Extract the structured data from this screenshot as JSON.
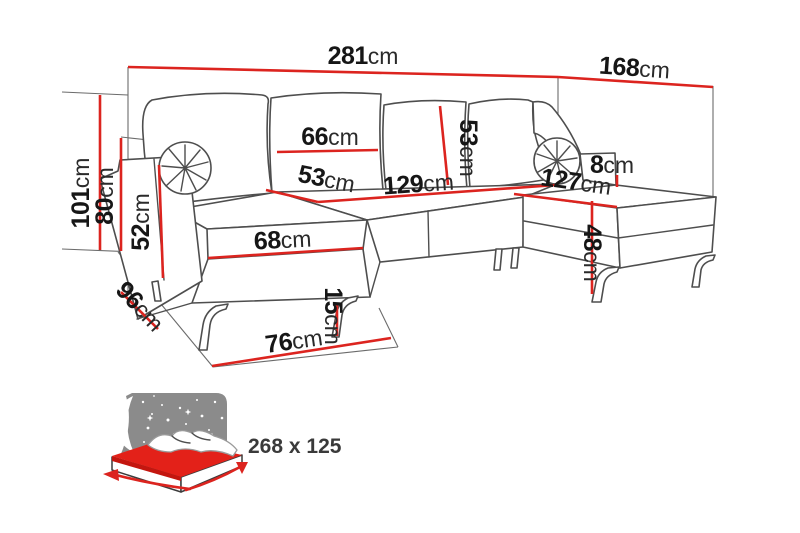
{
  "diagram_type": "sofa-dimension-diagram",
  "labels": {
    "total_width": {
      "num": "281",
      "unit": "cm"
    },
    "total_depth": {
      "num": "168",
      "unit": "cm"
    },
    "total_height": {
      "num": "101",
      "unit": "cm"
    },
    "backrest_height": {
      "num": "80",
      "unit": "cm"
    },
    "armrest_front_height": {
      "num": "52",
      "unit": "cm"
    },
    "back_cushion_width": {
      "num": "66",
      "unit": "cm"
    },
    "back_cushion_height": {
      "num": "53",
      "unit": "cm"
    },
    "seat_depth": {
      "num": "53",
      "unit": "cm"
    },
    "middle_seat_width": {
      "num": "129",
      "unit": "cm"
    },
    "right_chaise_width": {
      "num": "127",
      "unit": "cm"
    },
    "armrest_above_seat": {
      "num": "8",
      "unit": "cm"
    },
    "chaise_cushion_width": {
      "num": "68",
      "unit": "cm"
    },
    "seat_height": {
      "num": "48",
      "unit": "cm"
    },
    "side_depth": {
      "num": "96",
      "unit": "cm"
    },
    "chaise_front_width": {
      "num": "76",
      "unit": "cm"
    },
    "leg_height": {
      "num": "15",
      "unit": "cm"
    }
  },
  "sleeping_function": {
    "icon": "sofa-bed-night-icon",
    "size_label": "268 x 125"
  },
  "colors": {
    "dimension_red": "#dc241f",
    "outline_gray": "#4e4e4e",
    "label_black": "#161616",
    "night_panel_gray": "#8b8b8b",
    "mattress_red": "#e32119",
    "background": "#ffffff"
  }
}
